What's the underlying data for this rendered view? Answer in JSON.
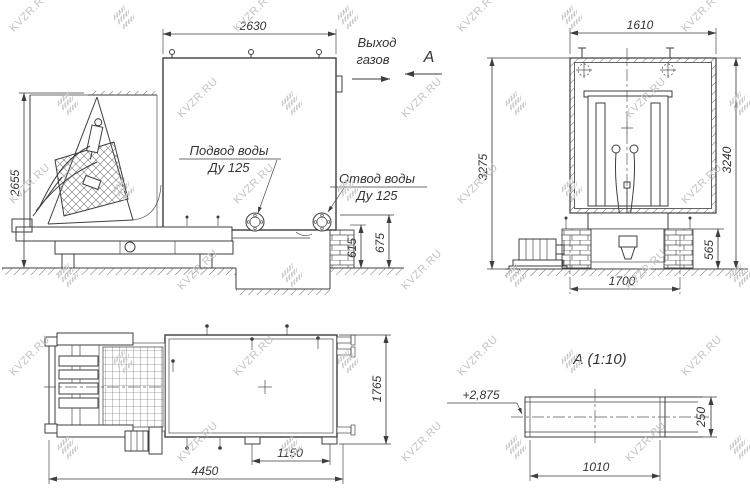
{
  "watermark": {
    "text": "KVZR.RU"
  },
  "colors": {
    "background": "#ffffff",
    "line": "#3e3e3e",
    "watermark": "#c3c3c3"
  },
  "side_view": {
    "dim_top_width": "2630",
    "dim_left_height": "2655",
    "dim_flange_axis_height": "615",
    "dim_foundation_height": "675",
    "gas_outlet_label_line1": "Выход",
    "gas_outlet_label_line2": "газов",
    "view_arrow_label": "А",
    "water_inlet_label_line1": "Подвод воды",
    "water_inlet_label_line2": "Ду 125",
    "water_outlet_label_line1": "Отвод воды",
    "water_outlet_label_line2": "Ду 125"
  },
  "front_view": {
    "dim_top_width": "1610",
    "dim_left_height": "3275",
    "dim_right_height": "3240",
    "dim_pedestal_height": "565",
    "dim_bottom_width": "1700"
  },
  "plan_view": {
    "dim_overall_length": "4450",
    "dim_support_spacing": "1150",
    "dim_width": "1765"
  },
  "detail_view": {
    "title": "А  (1:10)",
    "elevation_mark": "+2,875",
    "dim_width": "1010",
    "dim_height": "250"
  }
}
